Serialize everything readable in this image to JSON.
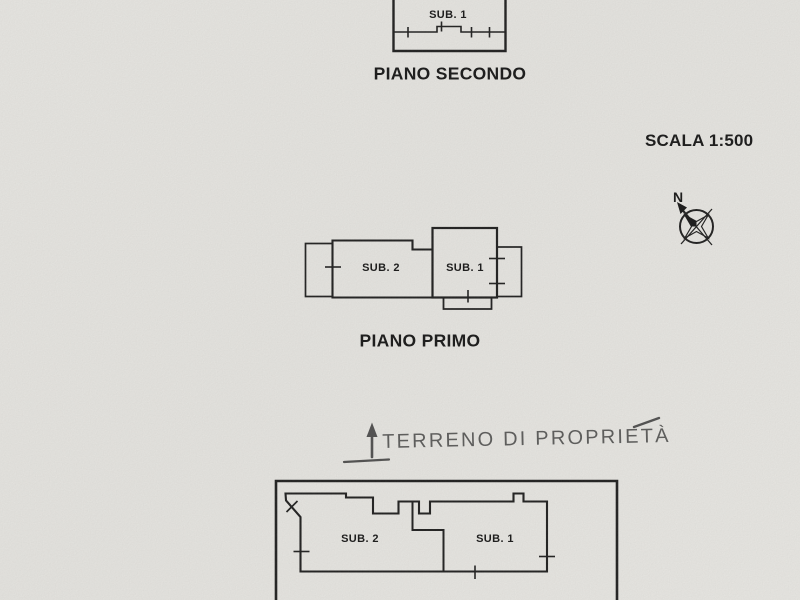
{
  "plans": {
    "secondo": {
      "caption": "PIANO SECONDO",
      "sub1": "SUB. 1"
    },
    "primo": {
      "caption": "PIANO PRIMO",
      "sub1": "SUB. 1",
      "sub2": "SUB. 2"
    },
    "terra": {
      "sub1": "SUB. 1",
      "sub2": "SUB. 2"
    }
  },
  "scale": {
    "label": "SCALA 1:500"
  },
  "compass": {
    "north": "N"
  },
  "handwriting": {
    "text": "TERRENO DI PROPRIETÀ"
  },
  "colors": {
    "paper": "#e9e8e4",
    "ink": "#1c1c1c",
    "pencil": "#4e4e4e"
  }
}
